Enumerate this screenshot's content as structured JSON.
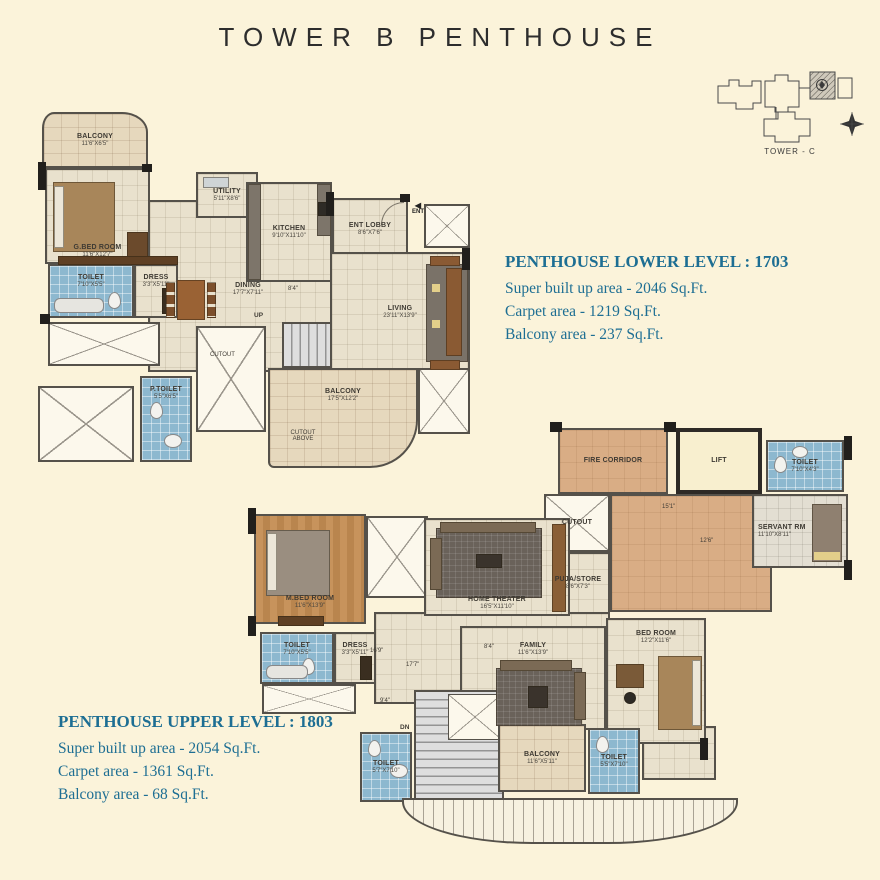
{
  "page": {
    "title": "TOWER B PENTHOUSE",
    "background": "#fbf3da"
  },
  "key_plan": {
    "label": "TOWER - C"
  },
  "colors": {
    "accent_text": "#1d6e93",
    "wall": "#55514a",
    "toilet_floor": "#8db8cf",
    "wood_floor": "#c7935c",
    "corridor_floor": "#d9ad85",
    "lift_floor": "#f8efcf"
  },
  "lower_level": {
    "heading": "PENTHOUSE LOWER LEVEL : 1703",
    "area_lines": [
      "Super built up area - 2046 Sq.Ft.",
      "Carpet area - 1219 Sq.Ft.",
      "Balcony area - 237 Sq.Ft."
    ],
    "rooms": [
      {
        "name": "BALCONY",
        "dim": "11'6\"X6'5\""
      },
      {
        "name": "G.BED ROOM",
        "dim": "11'6\"X12'7\""
      },
      {
        "name": "TOILET",
        "dim": "7'10\"X5'5\""
      },
      {
        "name": "DRESS",
        "dim": "3'3\"X5'11\""
      },
      {
        "name": "UTILITY",
        "dim": "5'11\"X8'6\""
      },
      {
        "name": "KITCHEN",
        "dim": "9'10\"X11'10\""
      },
      {
        "name": "ENT LOBBY",
        "dim": "8'6\"X7'6\""
      },
      {
        "name": "DINING",
        "dim": "17'7\"X7'11\""
      },
      {
        "name": "LIVING",
        "dim": "23'11\"X13'9\""
      },
      {
        "name": "P.TOILET",
        "dim": "5'5\"X6'5\""
      },
      {
        "name": "BALCONY",
        "dim": "17'5\"X12'2\""
      }
    ],
    "annotations": {
      "up": "UP",
      "cutout": "CUTOUT",
      "cutout_above": "CUTOUT ABOVE",
      "ent": "ENT",
      "dim_8_4": "8'4\""
    }
  },
  "upper_level": {
    "heading": "PENTHOUSE UPPER LEVEL : 1803",
    "area_lines": [
      "Super built up area - 2054 Sq.Ft.",
      "Carpet area - 1361 Sq.Ft.",
      "Balcony area - 68 Sq.Ft."
    ],
    "rooms": [
      {
        "name": "FIRE CORRIDOR"
      },
      {
        "name": "LIFT"
      },
      {
        "name": "TOILET",
        "dim": "7'10\"X4'3\""
      },
      {
        "name": "SERVANT RM",
        "dim": "11'10\"X8'11\""
      },
      {
        "name": "PUJA/STORE",
        "dim": "8'6\"X7'3\""
      },
      {
        "name": "M.BED ROOM",
        "dim": "11'6\"X13'9\""
      },
      {
        "name": "TOILET",
        "dim": "7'10\"X5'5\""
      },
      {
        "name": "DRESS",
        "dim": "3'3\"X5'11\""
      },
      {
        "name": "HOME THEATER",
        "dim": "16'5\"X11'10\""
      },
      {
        "name": "FAMILY",
        "dim": "11'6\"X13'9\""
      },
      {
        "name": "BED ROOM",
        "dim": "12'2\"X11'6\""
      },
      {
        "name": "TOILET",
        "dim": "5'7\"X7'10\""
      },
      {
        "name": "BALCONY",
        "dim": "11'6\"X5'11\""
      },
      {
        "name": "TOILET",
        "dim": "5'5\"X7'10\""
      }
    ],
    "annotations": {
      "dn": "DN",
      "cutout": "CUTOUT",
      "dim_15_1": "15'1\"",
      "dim_12_6": "12'6\"",
      "dim_16_9": "16'9\"",
      "dim_17_7": "17'7\"",
      "dim_8_4": "8'4\"",
      "dim_9_4": "9'4\""
    }
  }
}
